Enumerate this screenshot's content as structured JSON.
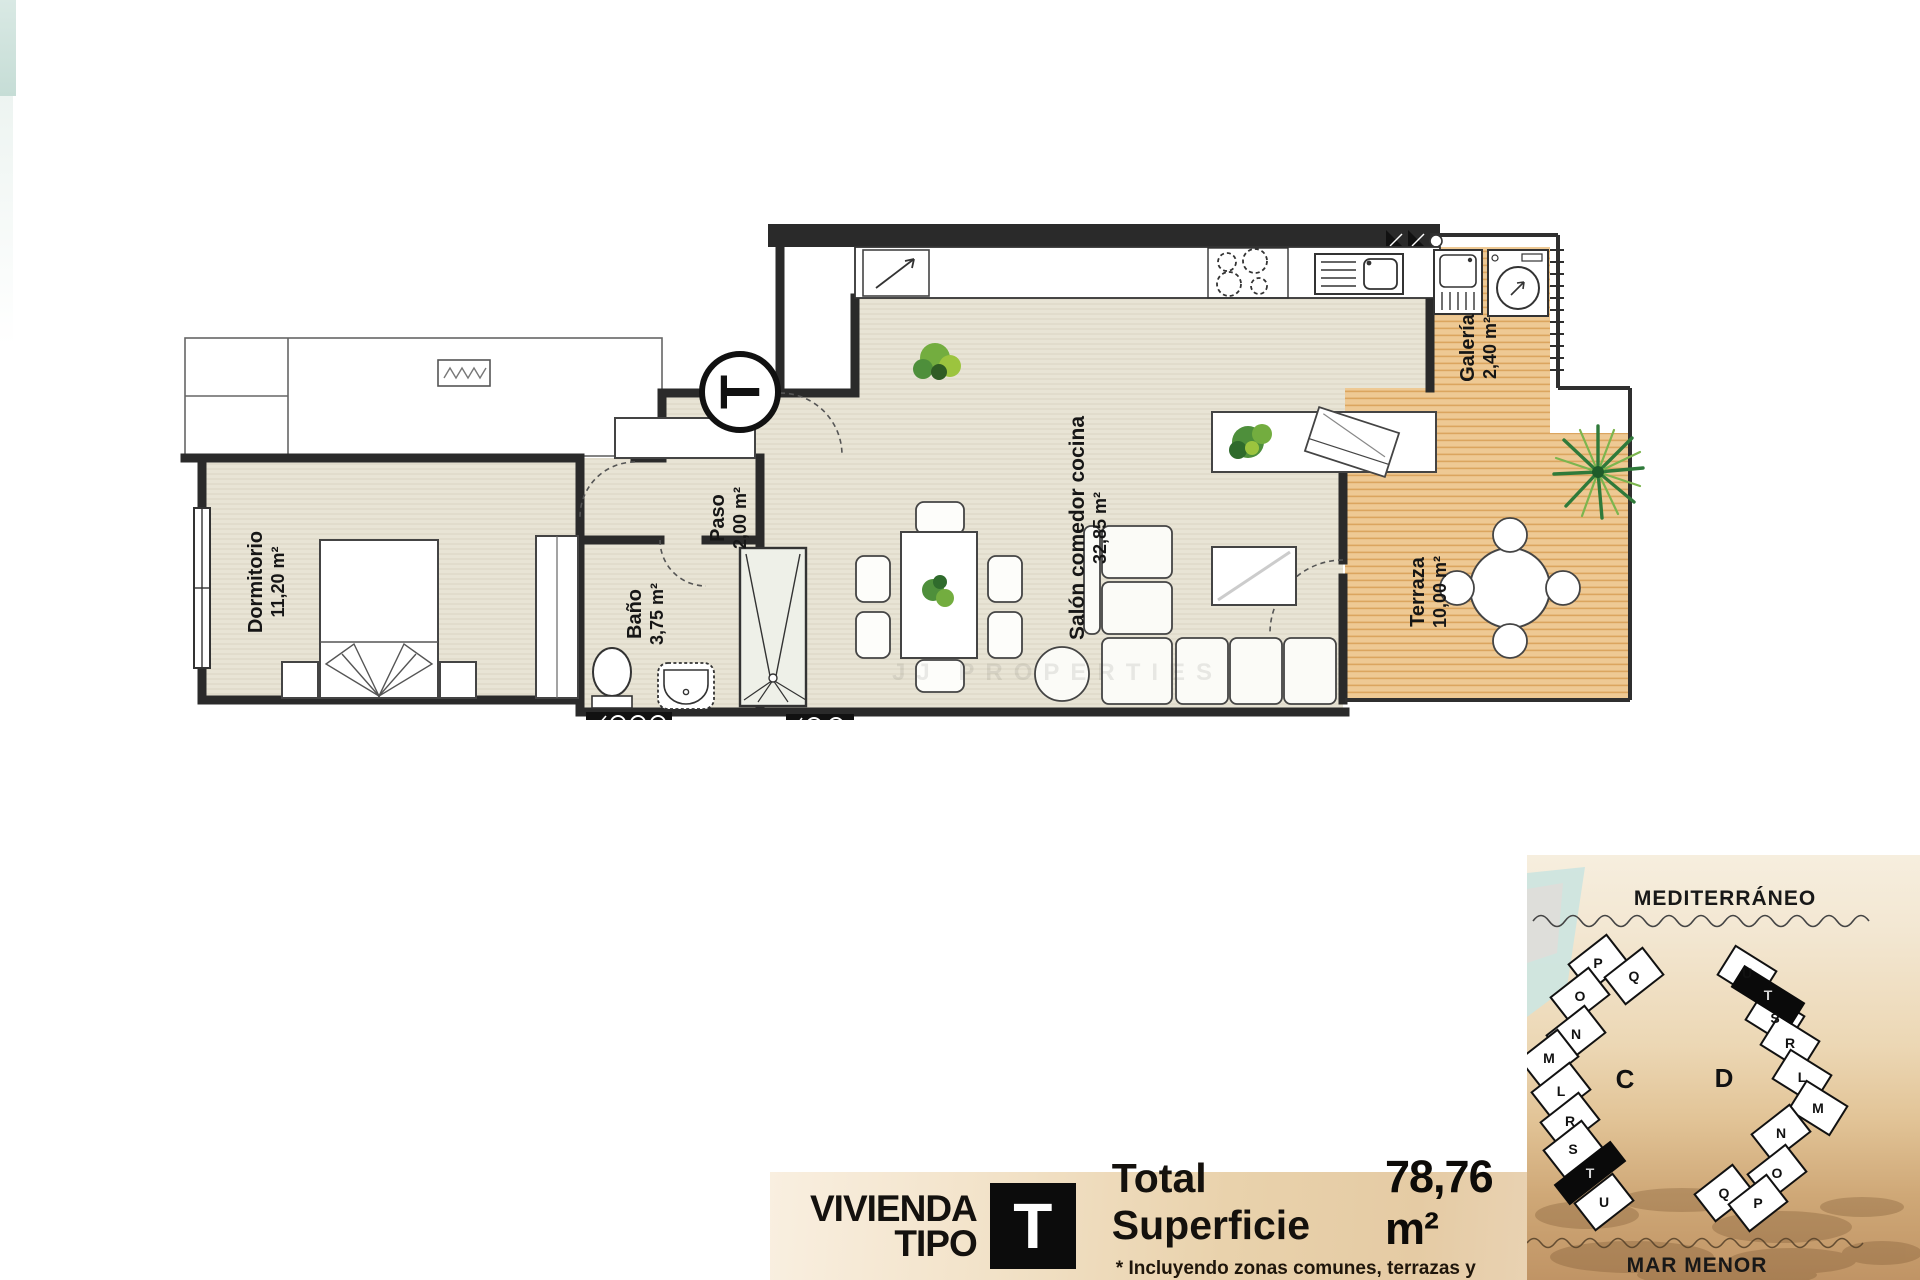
{
  "plan": {
    "rooms": [
      {
        "name": "Dormitorio",
        "area": "11,20 m²"
      },
      {
        "name": "Paso",
        "area": "2,00 m²"
      },
      {
        "name": "Baño",
        "area": "3,75 m²"
      },
      {
        "name": "Salón comedor cocina",
        "area": "32,85 m²"
      },
      {
        "name": "Galería",
        "area": "2,40 m²"
      },
      {
        "name": "Terraza",
        "area": "10,00 m²"
      }
    ],
    "entrance_marker": "T",
    "watermark": "JJ PROPERTIES"
  },
  "site_map": {
    "sea_label": "MEDITERRÁNEO",
    "lagoon_label": "MAR MENOR",
    "blocks": [
      {
        "label": "C",
        "units": [
          "P",
          "Q",
          "O",
          "N",
          "M",
          "L",
          "R",
          "S",
          "T",
          "U"
        ],
        "highlight": "T"
      },
      {
        "label": "D",
        "units": [
          "U",
          "T",
          "S",
          "R",
          "L",
          "M",
          "N",
          "O",
          "Q",
          "P"
        ],
        "highlight": "T"
      }
    ]
  },
  "banner": {
    "dwelling_label_line1": "VIVIENDA",
    "dwelling_label_line2": "TIPO",
    "type_letter": "T",
    "total_label": "Total Superficie",
    "total_value": "78,76 m²",
    "footnote": "* Incluyendo zonas comunes, terrazas y galería al 100%."
  },
  "colors": {
    "floor": "#e8e4d5",
    "wood": "#eec994",
    "wall": "#2a2a2a",
    "sand": "#c09465",
    "teal": "#cde5df",
    "highlight": "#0c0c0c"
  }
}
